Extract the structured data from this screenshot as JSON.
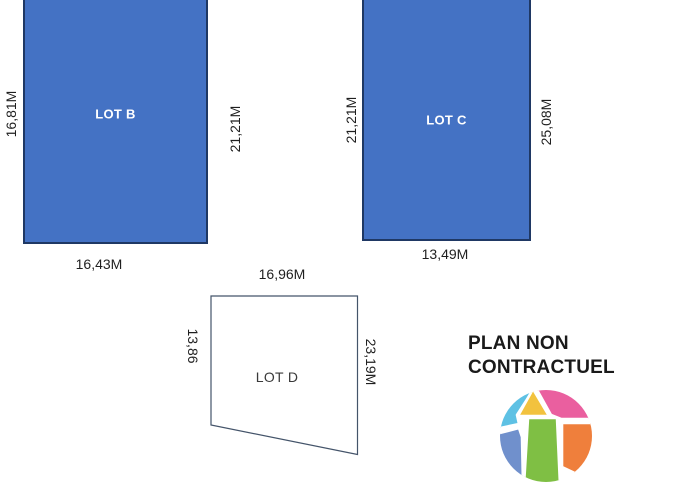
{
  "plan": {
    "lot_b": {
      "name": "LOT B",
      "dim_left": "16,81M",
      "dim_right": "21,21M",
      "dim_bottom": "16,43M"
    },
    "lot_c": {
      "name": "LOT C",
      "dim_left": "21,21M",
      "dim_right": "25,08M",
      "dim_bottom": "13,49M"
    },
    "lot_d": {
      "name": "LOT D",
      "dim_top": "16,96M",
      "dim_left": "13,86",
      "dim_right": "23,19M"
    },
    "disclaimer": {
      "line1": "PLAN NON",
      "line2": "CONTRACTUEL"
    },
    "colors": {
      "lot_fill": "#4472C4",
      "lot_border": "#1F3864",
      "lot_d_outline": "#44546A",
      "text": "#1f1f1f"
    },
    "logo": {
      "description": "multicolor faceted sphere logo",
      "segment_colors": {
        "light_blue": "#5EC1E4",
        "yellow": "#F2C23E",
        "pink": "#EA5F9F",
        "green": "#7FBF44",
        "orange": "#EF7F3C",
        "blue": "#7090CC"
      }
    }
  }
}
